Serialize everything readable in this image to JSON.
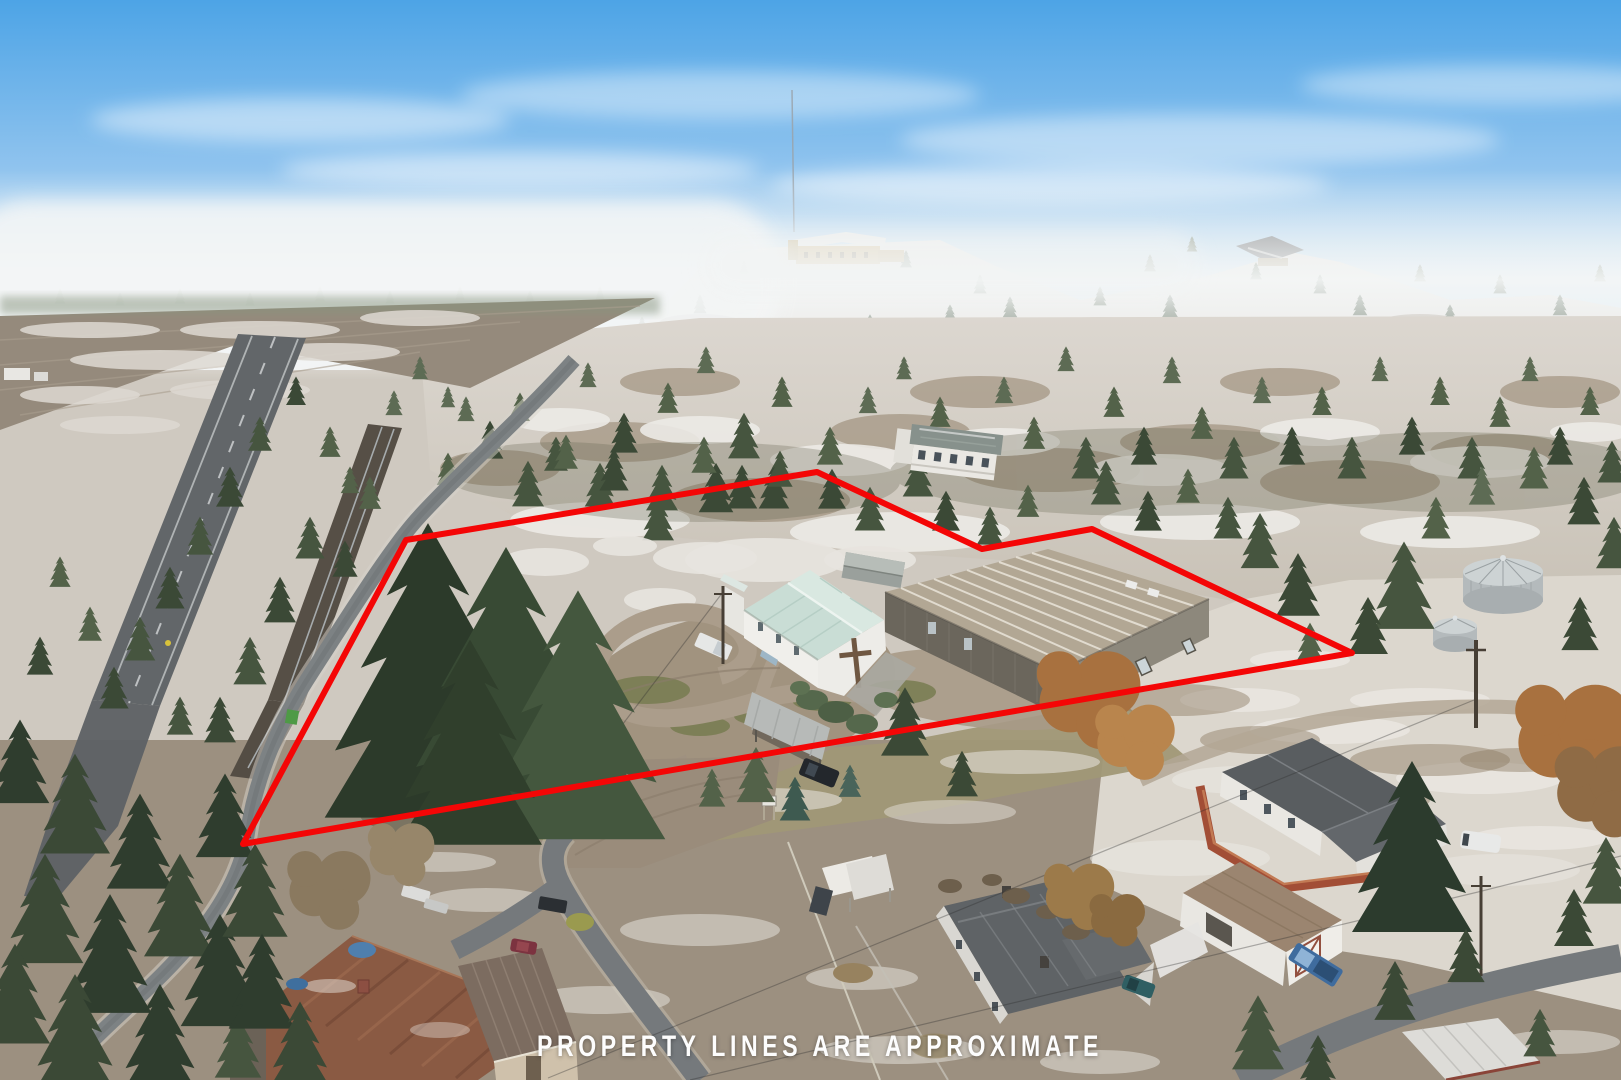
{
  "overlay": {
    "caption": "PROPERTY LINES ARE APPROXIMATE",
    "caption_color": "#fdfdfd",
    "boundary": {
      "points": "243,844 406,540 817,472 982,549 1092,529 1352,653",
      "color": "#f40606",
      "width": 6
    }
  },
  "palette": {
    "sky_top": "#4da4e6",
    "fog": "#f3f5f5",
    "snow": "#e7e4de",
    "hillside": "#d8d3cb",
    "dirt": "#a1937f",
    "asphalt": "#75797c",
    "conifer_dark": "#2f3d2e",
    "church_roof": "#c9ddd5",
    "warehouse_roof": "#b2a794",
    "deck_red": "#a24e36",
    "rust_roof": "#8a5a43"
  }
}
